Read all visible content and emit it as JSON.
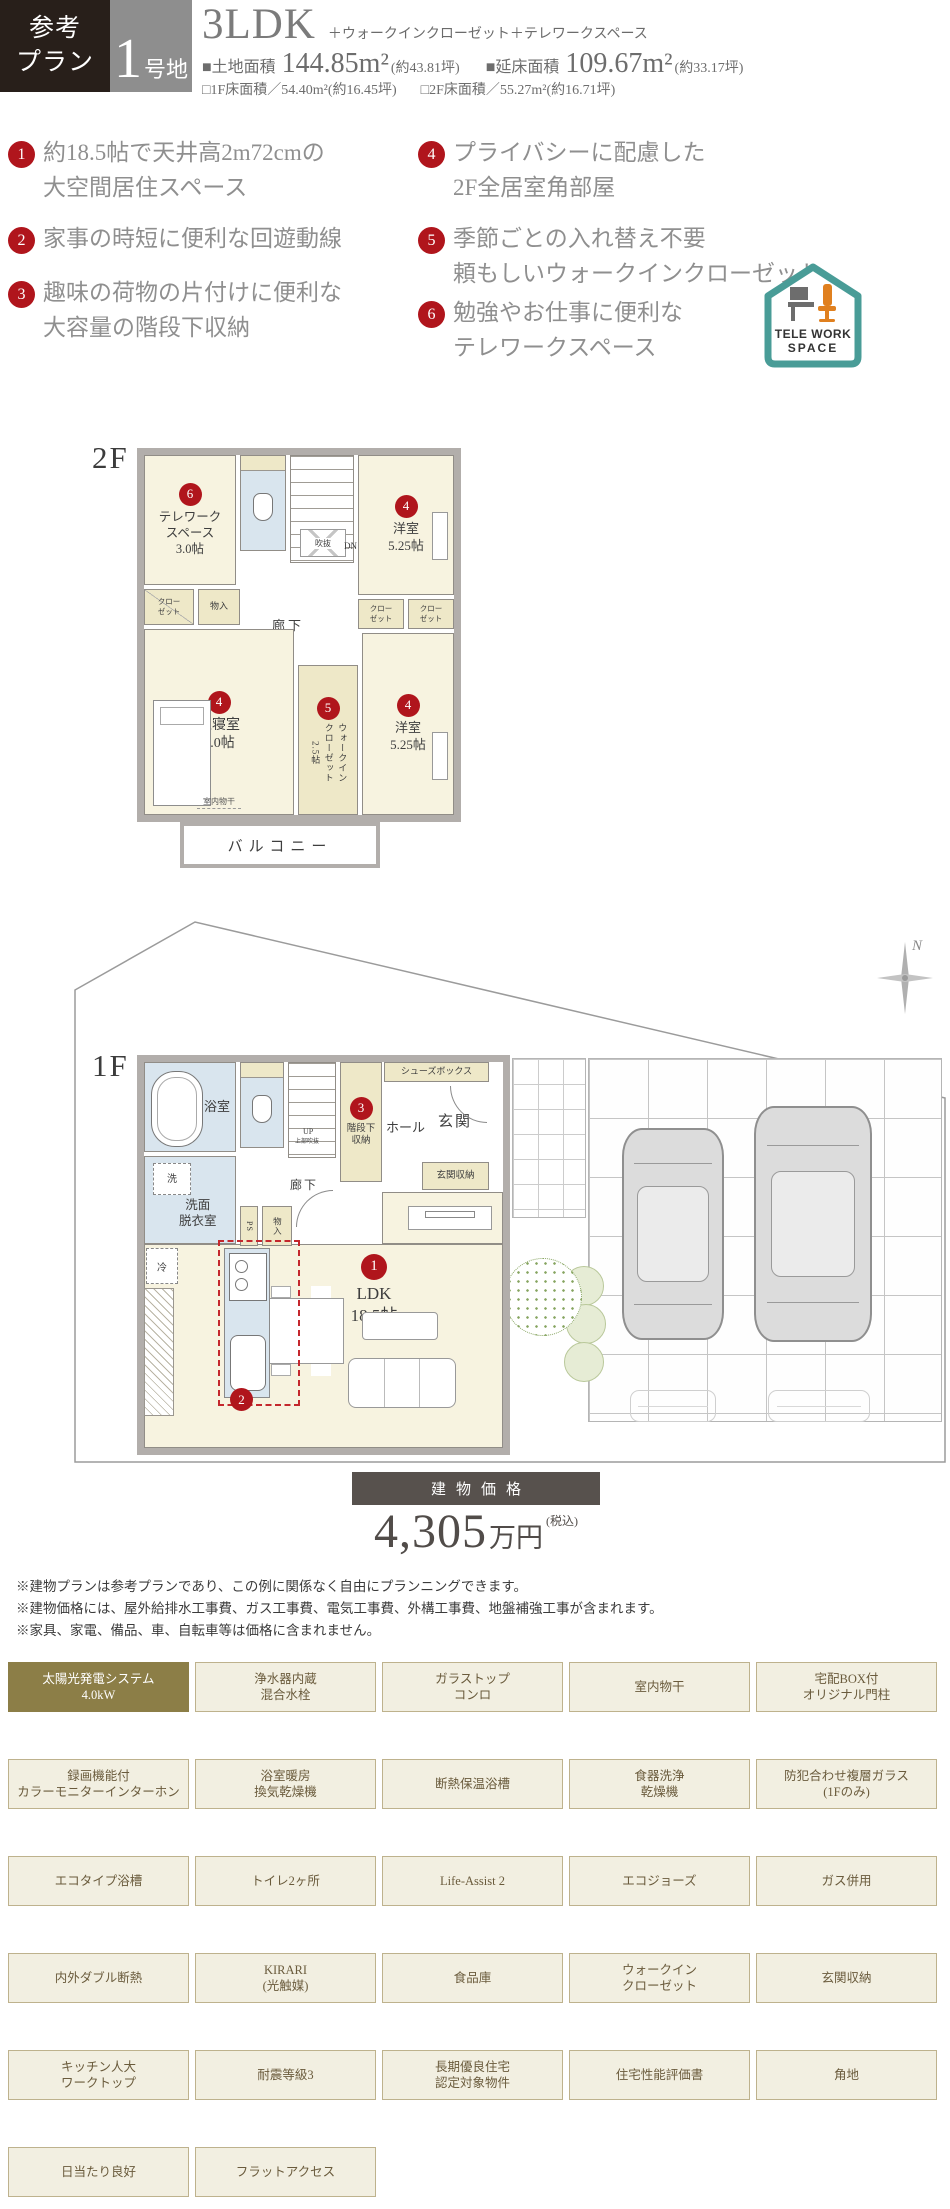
{
  "header": {
    "plan_label": "参考\nプラン",
    "lot_number": "1",
    "lot_suffix": "号地",
    "layout_type": "3LDK",
    "layout_suffix": "＋ウォークインクローゼット＋テレワークスペース",
    "land_area_label": "■土地面積",
    "land_area_value": "144.85m²",
    "land_area_tsubo": "(約43.81坪)",
    "total_area_label": "■延床面積",
    "total_area_value": "109.67m²",
    "total_area_tsubo": "(約33.17坪)",
    "f1_area": "□1F床面積／54.40m²(約16.45坪)",
    "f2_area": "□2F床面積／55.27m²(約16.71坪)"
  },
  "features": [
    {
      "num": "1",
      "text": "約18.5帖で天井高2m72cmの\n大空間居住スペース"
    },
    {
      "num": "2",
      "text": "家事の時短に便利な回遊動線"
    },
    {
      "num": "3",
      "text": "趣味の荷物の片付けに便利な\n大容量の階段下収納"
    },
    {
      "num": "4",
      "text": "プライバシーに配慮した\n2F全居室角部屋"
    },
    {
      "num": "5",
      "text": "季節ごとの入れ替え不要\n頼もしいウォークインクローゼット"
    },
    {
      "num": "6",
      "text": "勉強やお仕事に便利な\nテレワークスペース"
    }
  ],
  "telework_logo": {
    "line1": "TELE WORK",
    "line2": "SPACE"
  },
  "floor2": {
    "label": "2F",
    "balcony": "バルコニー",
    "telework": {
      "badge": "6",
      "name": "テレワーク\nスペース\n3.0帖"
    },
    "bedroom_top": {
      "badge": "4",
      "name": "洋室\n5.25帖"
    },
    "bedroom_bottom": {
      "badge": "4",
      "name": "洋室\n5.25帖"
    },
    "master": {
      "badge": "4",
      "name": "主寝室\n7.0帖"
    },
    "wic": {
      "badge": "5",
      "name": "ウォークイン\nクローゼット\n2.5帖"
    },
    "closet_left": "クロー\nゼット",
    "closet_r1": "クロー\nゼット",
    "closet_r2": "クロー\nゼット",
    "storage": "物入",
    "corridor": "廊下",
    "void": "吹抜",
    "down": "DN",
    "drying": "室内物干"
  },
  "floor1": {
    "label": "1F",
    "bath": "浴室",
    "wash": "洗",
    "powder": "洗面\n脱衣室",
    "fridge": "冷",
    "up": "UP",
    "void_above": "上部吹抜",
    "under_stairs": {
      "badge": "3",
      "name": "階段下\n収納"
    },
    "hall": "ホール",
    "shoes": "シューズボックス",
    "entrance": "玄関",
    "entrance_storage": "玄関収納",
    "corridor": "廊下",
    "ps": "PS",
    "storage": "物入",
    "ldk": {
      "badge": "1",
      "name": "LDK\n18.5帖"
    },
    "circulation_badge": "2"
  },
  "compass": {
    "label": "N"
  },
  "price": {
    "bar_label": "建物価格",
    "amount": "4,305",
    "unit": "万円",
    "tax": "(税込)"
  },
  "disclaimers": [
    "※建物プランは参考プランであり、この例に関係なく自由にプランニングできます。",
    "※建物価格には、屋外給排水工事費、ガス工事費、電気工事費、外構工事費、地盤補強工事が含まれます。",
    "※家具、家電、備品、車、自転車等は価格に含まれません。"
  ],
  "grid": {
    "cells": [
      "太陽光発電システム\n4.0kW",
      "浄水器内蔵\n混合水栓",
      "ガラストップ\nコンロ",
      "室内物干",
      "宅配BOX付\nオリジナル門柱",
      "録画機能付\nカラーモニターインターホン",
      "浴室暖房\n換気乾燥機",
      "断熱保温浴槽",
      "食器洗浄\n乾燥機",
      "防犯合わせ複層ガラス\n(1Fのみ)",
      "エコタイプ浴槽",
      "トイレ2ヶ所",
      "Life-Assist 2",
      "エコジョーズ",
      "ガス併用",
      "内外ダブル断熱",
      "KIRARI\n(光触媒)",
      "食品庫",
      "ウォークイン\nクローゼット",
      "玄関収納",
      "キッチン人大\nワークトップ",
      "耐震等級3",
      "長期優良住宅\n認定対象物件",
      "住宅性能評価書",
      "角地",
      "日当たり良好",
      "フラットアクセス"
    ]
  }
}
